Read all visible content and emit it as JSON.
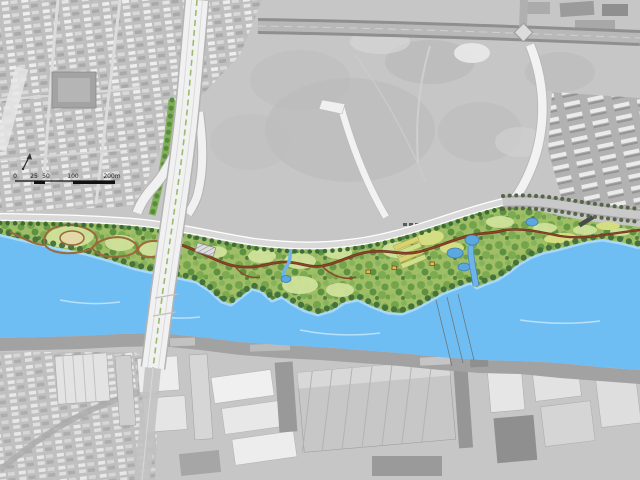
{
  "map": {
    "kind": "riverfront-park-masterplan-over-aerial",
    "scale_bar": {
      "labels": [
        "0",
        "25",
        "50",
        "100",
        "200m"
      ]
    },
    "icons": {
      "north_arrow": "north-arrow-icon"
    },
    "colors": {
      "river": "#6fbef3",
      "river_light": "#b3ddf9",
      "park_base": "#9fbe66",
      "tree_dark": "#41703a",
      "lawn": "#cfe29b",
      "trail_red": "#8e452b",
      "trail_brown": "#9a6a3a",
      "road_overlay": "#f2f2f2",
      "aerial_gray": "#c6c6c6",
      "south_bank": "#a2a2a2",
      "pond": "#5ba8e0"
    }
  }
}
